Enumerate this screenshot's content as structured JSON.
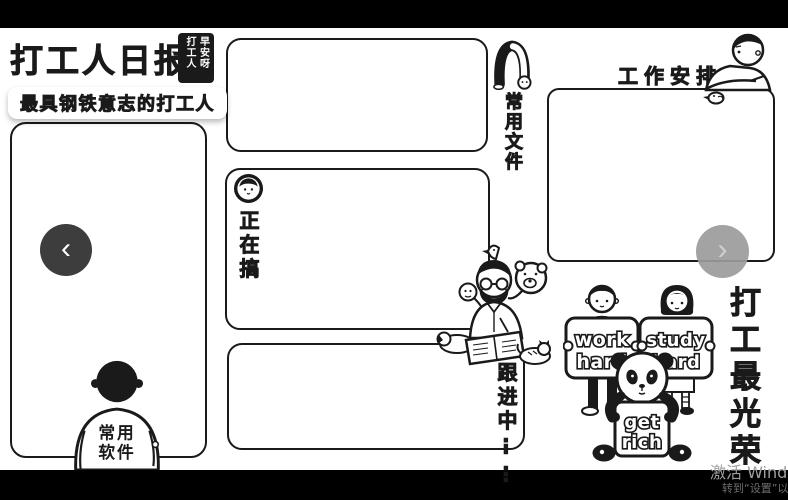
{
  "header": {
    "title": "打工人日报",
    "badge": {
      "left_col": "打工人",
      "right_col": "早安呀"
    },
    "subtitle": "最具钢铁意志的打工人"
  },
  "panels": {
    "software": {
      "label_line1": "常用",
      "label_line2": "软件"
    },
    "files": {
      "label": "常用文件"
    },
    "doing": {
      "label": "正在搞"
    },
    "following": {
      "label": "跟进中",
      "dots": "⋮⋮"
    },
    "schedule": {
      "label": "工作安排"
    }
  },
  "carousel": {
    "prev_icon": "‹",
    "next_icon": "›"
  },
  "slogan": {
    "vertical": "打工最光荣",
    "work_sign": {
      "line1": "work",
      "line2": "hard"
    },
    "study_sign": {
      "line1": "study",
      "line2": "hard"
    },
    "rich_sign": {
      "line1": "get",
      "line2": "rich"
    }
  },
  "watermark": {
    "line1": "激活 Wind",
    "line2": "转到“设置”以"
  },
  "icons": {
    "doing_badge": "boy-face-badge",
    "files_icon": "bowing-person",
    "schedule_icon": "leaning-person-with-bird",
    "software_icon": "person-from-behind",
    "desk_scene": "man-reading-newspaper-with-pets",
    "work_figure": "boy-holding-sign",
    "study_figure": "girl-holding-sign",
    "rich_figure": "panda-holding-sign",
    "prev": "chevron-left",
    "next": "chevron-right"
  },
  "colors": {
    "ink": "#1a1a1a",
    "background": "#ffffff",
    "letterbox": "#000000",
    "prev_button": "#3d3d3d",
    "next_button": "#9b9b9b",
    "watermark": "#9f9f9f"
  }
}
